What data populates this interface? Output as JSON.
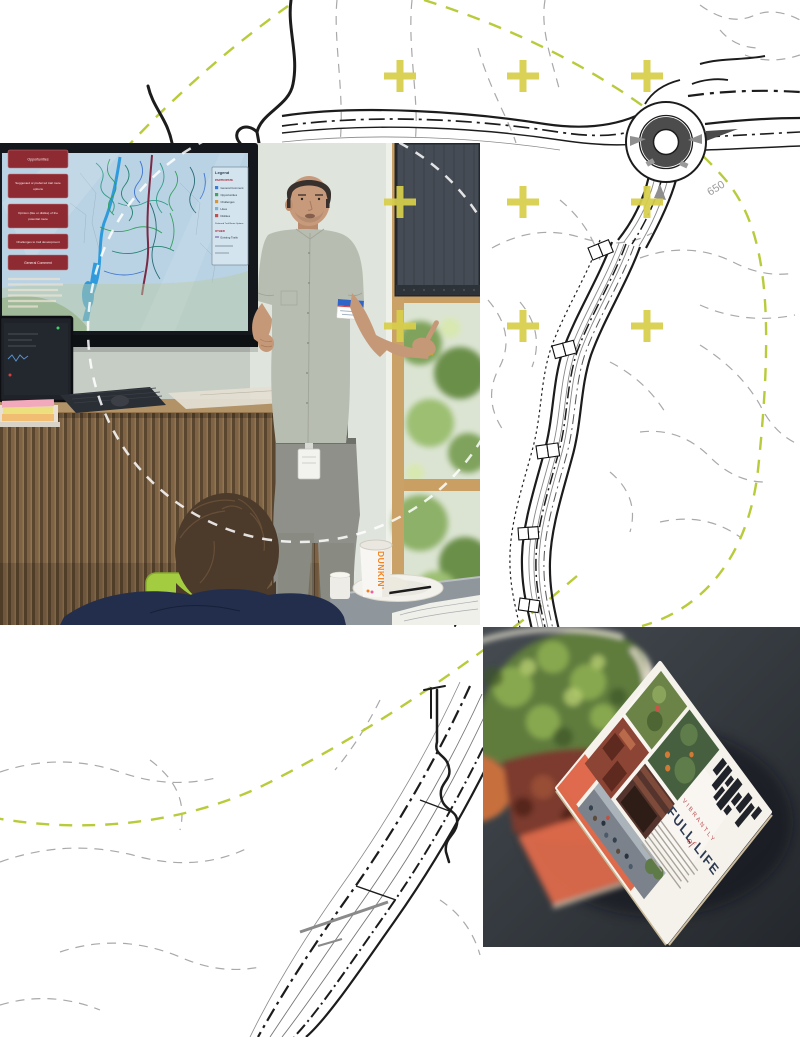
{
  "collage": {
    "background_color": "#ffffff",
    "site_plan": {
      "contour_label_650": "650",
      "line_color": "#1c1c1c",
      "contour_color": "#a9a9a9",
      "dashed_circle_color": "#b9cb3a",
      "plus_marker_color": "#d7cf4b"
    },
    "presentation_photo": {
      "screen": {
        "button_color": "#8d2a32",
        "buttons": [
          {
            "lines": [
              "Opportunities",
              ""
            ]
          },
          {
            "lines": [
              "Suggested or preferred trail route",
              "options"
            ]
          },
          {
            "lines": [
              "Opinion (like or dislike) of the",
              "potential route"
            ]
          },
          {
            "lines": [
              "Challenges to trail development",
              ""
            ]
          },
          {
            "lines": [
              "General Comment",
              ""
            ]
          }
        ],
        "legend": {
          "title": "Legend",
          "section_participate": "PARTICIPATE",
          "items": [
            "General Comment",
            "Opportunities",
            "Challenges",
            "Likes",
            "Dislikes",
            "Preferred Trail Route Options"
          ],
          "section_other": "OTHER",
          "other_items": [
            "Existing Trails"
          ]
        }
      },
      "cup_brand": "DUNKIN'"
    },
    "magazine_photo": {
      "headline_eyebrow": "VIBRANTLY",
      "headline_word1": "FULL",
      "headline_word2": "of",
      "headline_word3": "LIFE",
      "accent_color": "#e0694e",
      "headline_color": "#2c3a52",
      "eyebrow_color": "#b84a4e"
    }
  }
}
